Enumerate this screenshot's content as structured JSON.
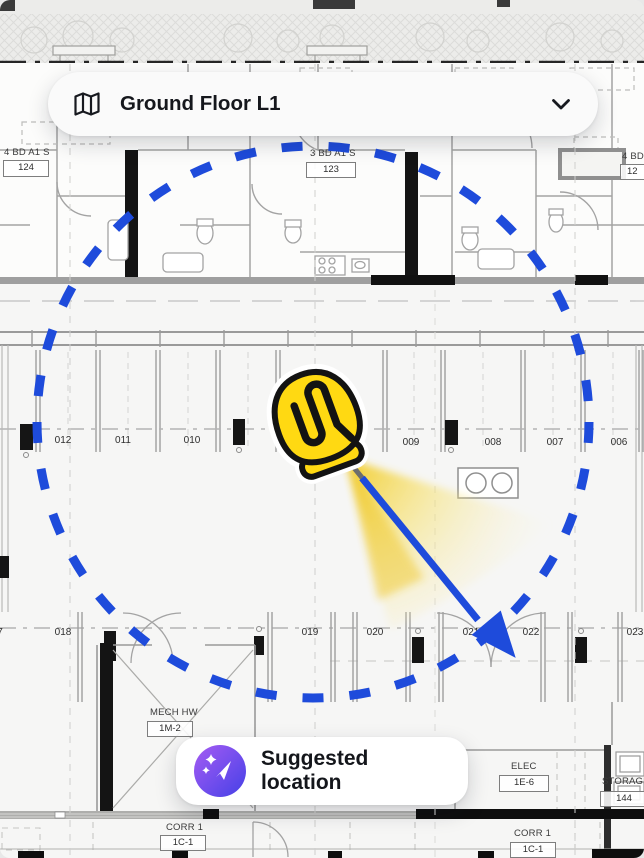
{
  "floor_selector": {
    "label": "Ground Floor L1"
  },
  "suggestion": {
    "label": "Suggested location"
  },
  "plan": {
    "units": [
      {
        "name": "4 BD A1 S",
        "number": "124"
      },
      {
        "name": "3 BD A1 S",
        "number": "123"
      },
      {
        "name": "4 BD",
        "number": "12"
      }
    ],
    "rooms": {
      "mech": {
        "name": "MECH HW",
        "number": "1M-2"
      },
      "elec": {
        "name": "ELEC",
        "number": "1E-6"
      },
      "storage": {
        "name": "STORAGE",
        "number": "144"
      },
      "corr_left": {
        "name": "CORR 1",
        "number": "1C-1"
      },
      "corr_right": {
        "name": "CORR 1",
        "number": "1C-1"
      }
    },
    "stalls_top": [
      "012",
      "011",
      "010",
      "009",
      "008",
      "007",
      "006"
    ],
    "stalls_bottom": [
      "7",
      "018",
      "019",
      "020",
      "021",
      "022",
      "023"
    ]
  },
  "colors": {
    "accent_blue": "#1e4bdb",
    "marker_yellow": "#ffd912",
    "cone_yellow": "#f2cb24",
    "icon_gradient_start": "#a55bf2",
    "icon_gradient_end": "#4540e6"
  }
}
